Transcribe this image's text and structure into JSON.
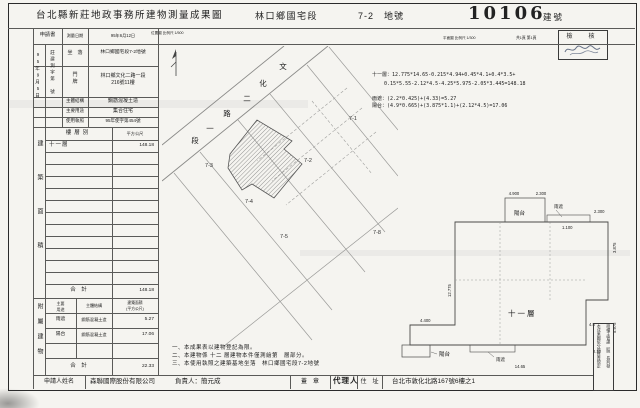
{
  "title": {
    "office": "台北縣新莊地政事務所建物測量成果圖",
    "section": "林口鄉國宅段",
    "lot": "7-2　地號",
    "building_no": "10106",
    "building_no_label": "建號"
  },
  "header": {
    "application": "申請書",
    "survey_date_label": "測量日期",
    "survey_date": "95年6月12日",
    "location_scale": "位置圖 比例尺 1/500",
    "plan_scale": "平面圖 比例尺 1/300",
    "pages": "共1頁 第1頁",
    "check_stamp": "檢　核"
  },
  "receipt": {
    "date": "95年9月5日",
    "doc_no": "莊建測字第　號"
  },
  "info": {
    "site_label": "坐　落",
    "site": "林口鄉國宅段7-2地號",
    "door_label": "門\n牌",
    "door": "林口鄉文化二路一段\n216號11樓",
    "structure_label": "主體結構",
    "structure": "鋼筋混凝土造",
    "use_label": "主要用途",
    "use": "集合住宅",
    "license_label": "使用執照",
    "license": "95年使字第454號"
  },
  "area_table": {
    "side_label": "建築面積",
    "col_floor": "樓層別",
    "col_sqm": "平方公尺",
    "floor": "十一層",
    "floor_area": "148.18",
    "total_label": "合　計",
    "total": "148.18"
  },
  "annex_table": {
    "side_label": "附屬建物",
    "col_use": "主要\n用途",
    "col_structure": "主體結構",
    "col_area": "建築面積\n(平方公尺)",
    "rows": [
      {
        "use": "雨遮",
        "structure": "鋼筋混凝土造",
        "area": "5.27"
      },
      {
        "use": "陽台",
        "structure": "鋼筋混凝土造",
        "area": "17.06"
      }
    ],
    "total_label": "合　計",
    "total": "22.33"
  },
  "calc": {
    "l1": "十一層：12.775*14.65-0.215*4.94+0.45*4.1+0.4*3.5+",
    "l2": "0.15*5.55-2.12*4.5-4.25*5.975-2.05*3.445=148.18",
    "l3": "雨遮：(2.2*0.425)+(4.33)=5.27",
    "l4": "陽台：(4.9*0.665)+(3.875*1.1)+(2.12*4.5)=17.06"
  },
  "site_plan": {
    "road": [
      "文",
      "化",
      "二",
      "路",
      "一",
      "段"
    ],
    "lots": [
      "7-1",
      "7-2",
      "7-3",
      "7-4",
      "7-5",
      "7-8"
    ]
  },
  "floor_plan": {
    "floor": "十一層",
    "balcony_top": "陽台",
    "balcony_bottom": "陽台",
    "canopy_top": "雨遮",
    "canopy_bottom": "雨遮",
    "dims": {
      "top_w1": "4.900",
      "top_w2": "2.300",
      "right_w": "1.100",
      "right_w2": "2.300",
      "right_h": "3.875",
      "left_h": "12.775",
      "wing_w": "4.400",
      "bottom_w": "14.65",
      "notch_w": "2.12",
      "notch_h": "4.5",
      "notch_side": "5.975"
    }
  },
  "notes": {
    "l1": "一、本成果表以建物登記為限。",
    "l2": "二、本建物係 十二 層建物本件僅測繪第　層部分。",
    "l3": "三、本使用執照之建築基地坐落　林口鄉國宅段7-2地號"
  },
  "footer": {
    "applicant_label": "申請人姓名",
    "applicant": "森聯國際股份有限公司",
    "principal": "負責人：簡元成",
    "seal": "蓋　章",
    "agent": "代理人",
    "address_label": "住　址",
    "address": "台北市敦化北路167號6樓之1"
  },
  "side_note": {
    "col1": "本成果圖依分層負責規定",
    "col2": "授權主管課（股）長判發"
  }
}
